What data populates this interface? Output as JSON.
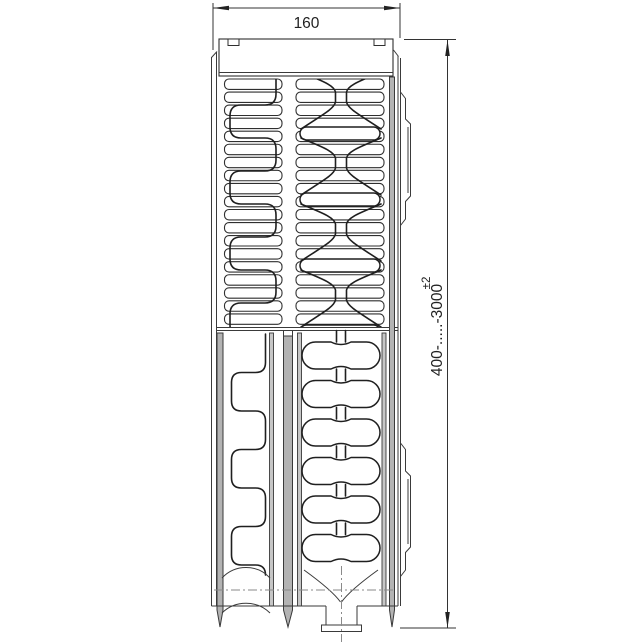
{
  "diagram": {
    "title": "radiator side-section technical drawing",
    "dimensions": {
      "depth": "160",
      "height_range": "400-.....-3000",
      "height_tolerance": "±2"
    },
    "colors": {
      "line": "#2f2f2f",
      "channel_fill": "#b3b3b3",
      "background": "#ffffff"
    }
  }
}
